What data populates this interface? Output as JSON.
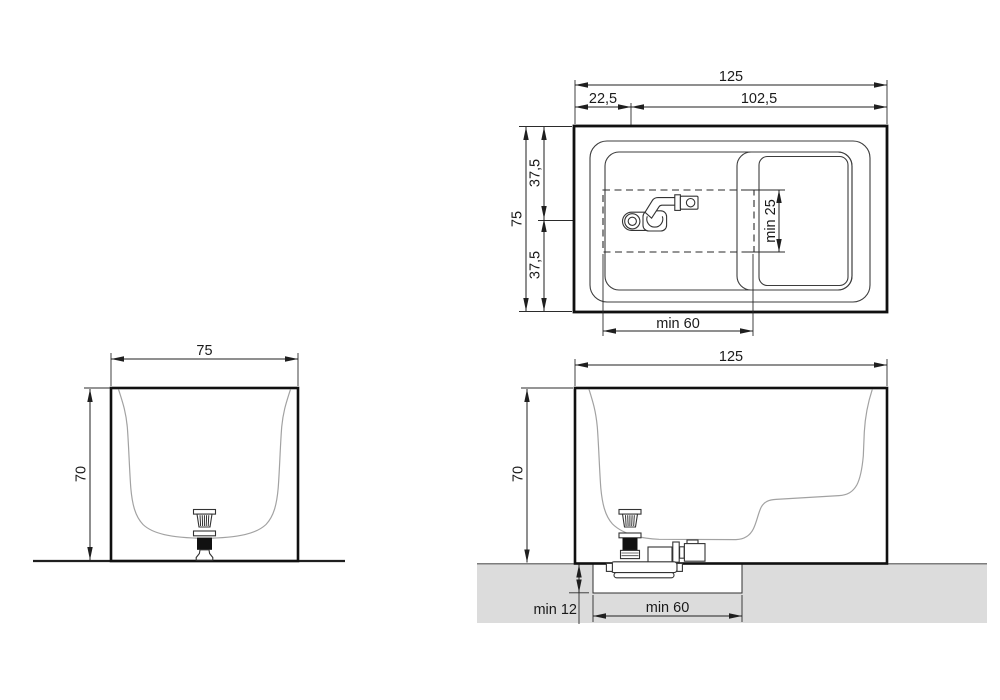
{
  "drawing": {
    "type": "bathtub-installation-technical-drawing",
    "plan": {
      "width_total": "125",
      "width_left": "22,5",
      "width_right": "102,5",
      "depth_total": "75",
      "depth_front": "37,5",
      "depth_back": "37,5",
      "seat_depth_min": "min 25",
      "drain_zone_min": "min 60"
    },
    "front": {
      "width": "75",
      "height": "70"
    },
    "side": {
      "length": "125",
      "height": "70",
      "recess_depth_min": "min 12",
      "recess_width_min": "min 60"
    },
    "colors": {
      "line": "#1a1a1a",
      "thin_line": "#3c3c3c",
      "profile_line": "#a2a2a2",
      "floor_fill": "#dcdcdc",
      "floor_line": "#7d7d7d",
      "drain_fill": "#111111",
      "background": "#ffffff"
    }
  }
}
